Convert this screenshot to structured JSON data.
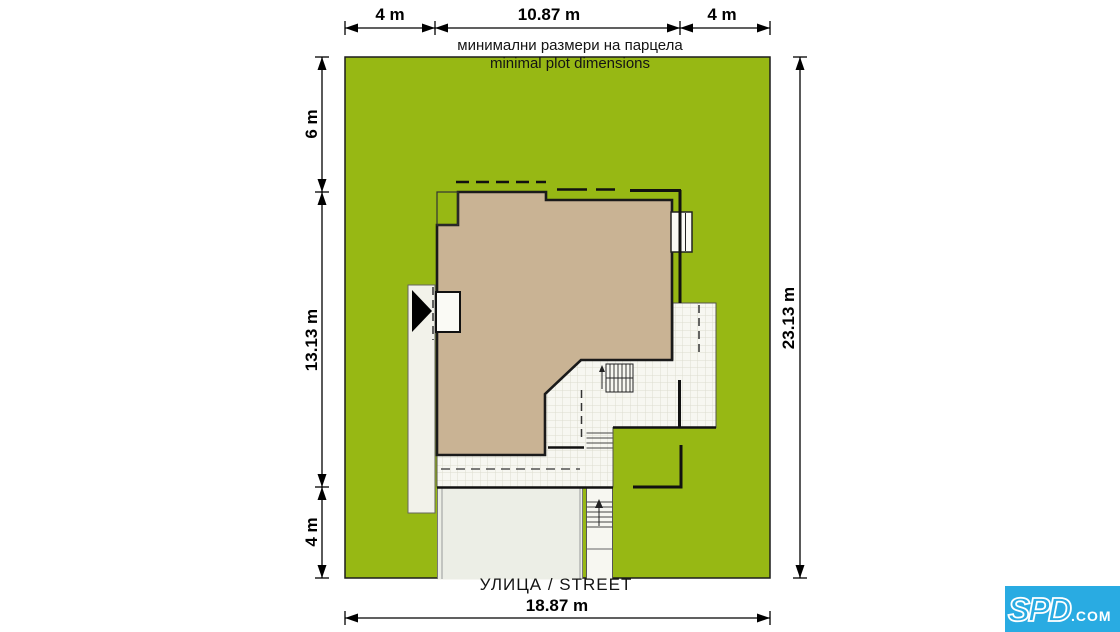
{
  "plot": {
    "label_bg": "минимални размери на парцела",
    "label_en": "minimal plot dimensions",
    "street": "УЛИЦА / STREET"
  },
  "dimensions": {
    "top_left": "4 m",
    "top_mid": "10.87 m",
    "top_right": "4 m",
    "left_top": "6 m",
    "left_mid": "13.13 m",
    "left_bottom": "4 m",
    "right_full": "23.13 m",
    "bottom_full": "18.87 m"
  },
  "colors": {
    "grass": "#97b814",
    "roof": "#c9b394",
    "terrace": "#f7f7f1",
    "driveway": "#eceee6",
    "logo_blue": "#29abe2"
  },
  "logo": {
    "brand": "SPD",
    "suffix": ".COM"
  }
}
